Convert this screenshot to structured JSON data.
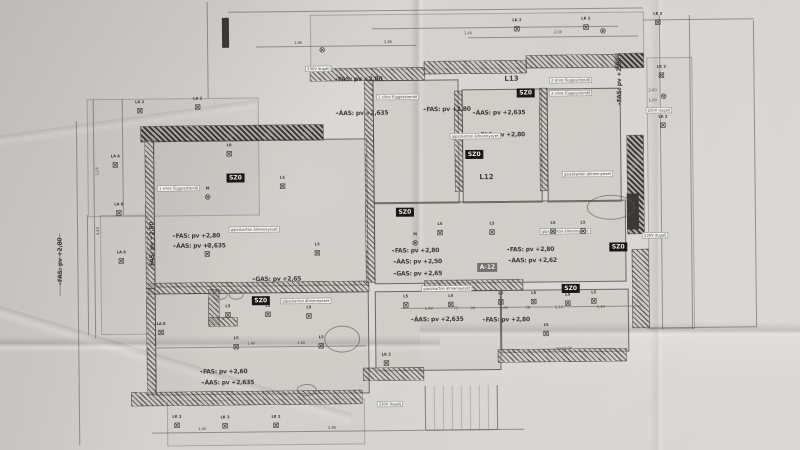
{
  "photo": {
    "colors": {
      "paper": "#d5d3cf",
      "ink": "#3b3a37",
      "chip_bg": "#171715",
      "chip_gray": "#73716d",
      "note_bg": "#f2f1ee",
      "line": "#56544f"
    }
  },
  "plan": {
    "ceiling_labels": [
      [
        "FAS: pv +2,80",
        360,
        79,
        0
      ],
      [
        "ÁAS: pv +2,635",
        363,
        113,
        0
      ],
      [
        "FAS: pv +2,80",
        448,
        110,
        0
      ],
      [
        "ÁAS: pv +2,635",
        500,
        114,
        0
      ],
      [
        "FAS: pv +2,80",
        502,
        136,
        0
      ],
      [
        "FAS: pv +2,80",
        196,
        234,
        0
      ],
      [
        "ÁAS: pv +2,635",
        199,
        244,
        0
      ],
      [
        "FAS: pv +2,80",
        415,
        251,
        0
      ],
      [
        "ÁAS: pv +2,50",
        417,
        262,
        0
      ],
      [
        "GAS: pv +2,65",
        417,
        274,
        0
      ],
      [
        "GAS: pv +2,65",
        276,
        278,
        0
      ],
      [
        "FAS: pv +2,80",
        530,
        251,
        0
      ],
      [
        "ÁAS: pv +2,62",
        532,
        262,
        0
      ],
      [
        "ÁAS: pv +2,635",
        436,
        320,
        0
      ],
      [
        "FAS: pv +2,80",
        505,
        321,
        0
      ],
      [
        "FAS: pv +2,60",
        222,
        370,
        0
      ],
      [
        "ÁAS: pv +2,635",
        226,
        381,
        0
      ],
      [
        "FAS: pv +2,80",
        152,
        243,
        -90
      ],
      [
        "FAS: pv +2,80",
        621,
        84,
        -90
      ],
      [
        "FAS: pv +2,80",
        60,
        258,
        -90
      ]
    ],
    "chips": [
      [
        "SZ0",
        236,
        176,
        ""
      ],
      [
        "SZ0",
        260,
        299,
        ""
      ],
      [
        "SZ0",
        405,
        212,
        ""
      ],
      [
        "SZ0",
        475,
        155,
        ""
      ],
      [
        "SZ0",
        527,
        94,
        ""
      ],
      [
        "SZ0",
        570,
        290,
        ""
      ],
      [
        "SZ0",
        618,
        249,
        ""
      ],
      [
        "A-12",
        487,
        268,
        "gray"
      ]
    ],
    "notes": [
      [
        "gipszkarton álmennyezet",
        254,
        228,
        ""
      ],
      [
        "gipszkarton álmennyezet",
        446,
        289,
        ""
      ],
      [
        "gipszkarton álmennyezet",
        476,
        137,
        ""
      ],
      [
        "gipszkarton álmennyezet",
        588,
        176,
        ""
      ],
      [
        "gipszkarton álmennyezet",
        305,
        300,
        ""
      ],
      [
        "gipszkarton álmennyezet",
        565,
        233,
        ""
      ],
      [
        "2 sínre függesztendő",
        572,
        82,
        ""
      ],
      [
        "2 sínre függesztendő",
        572,
        95,
        ""
      ],
      [
        "1 sínre függesztendő",
        179,
        186,
        ""
      ],
      [
        "1 sínre függesztendő",
        399,
        97,
        ""
      ],
      [
        "230V dugalj",
        320,
        68,
        ""
      ],
      [
        "230V dugalj",
        655,
        238,
        ""
      ],
      [
        "230V dugalj",
        660,
        113,
        ""
      ],
      [
        "230V dugalj",
        388,
        404,
        ""
      ],
      [
        "pv=3,00",
        563,
        350,
        "plain"
      ]
    ],
    "lamps": [
      [
        "LA 2",
        141,
        108,
        "s"
      ],
      [
        "LA 2",
        199,
        105,
        "s"
      ],
      [
        "LA 8",
        116,
        162,
        "s"
      ],
      [
        "LA 8",
        119,
        210,
        "s"
      ],
      [
        "LA 8",
        121,
        258,
        "s"
      ],
      [
        "LA 8",
        160,
        330,
        "s"
      ],
      [
        "LK 2",
        175,
        423,
        "s"
      ],
      [
        "LK 3",
        223,
        424,
        "s"
      ],
      [
        "LK 2",
        274,
        424,
        "s"
      ],
      [
        "LK 2",
        385,
        363,
        "s"
      ],
      [
        "LK 2",
        519,
        30,
        "s"
      ],
      [
        "LK 2",
        588,
        29,
        "s"
      ],
      [
        "LK 2",
        660,
        25,
        "s"
      ],
      [
        "LK 2",
        663,
        78,
        "s"
      ],
      [
        "LK 2",
        664,
        128,
        "s"
      ],
      [
        "",
        665,
        99,
        "c"
      ],
      [
        "",
        605,
        33,
        "c"
      ],
      [
        "",
        324,
        49,
        "c"
      ],
      [
        "M",
        415,
        243,
        "c"
      ],
      [
        "M",
        208,
        195,
        "c"
      ],
      [
        "L9",
        230,
        152,
        "s"
      ],
      [
        "L5",
        283,
        185,
        "s"
      ],
      [
        "L5",
        207,
        252,
        "s"
      ],
      [
        "L3",
        317,
        252,
        "s"
      ],
      [
        "L5",
        440,
        233,
        "s"
      ],
      [
        "L5",
        492,
        233,
        "s"
      ],
      [
        "L5",
        553,
        233,
        "s"
      ],
      [
        "L5",
        583,
        233,
        "s"
      ],
      [
        "L5",
        405,
        305,
        "s"
      ],
      [
        "L5",
        450,
        305,
        "s"
      ],
      [
        "L5",
        500,
        303,
        "s"
      ],
      [
        "L5",
        533,
        303,
        "s"
      ],
      [
        "L5",
        567,
        305,
        "s"
      ],
      [
        "L5",
        593,
        303,
        "s"
      ],
      [
        "L5",
        227,
        313,
        "s"
      ],
      [
        "L5",
        267,
        313,
        "s"
      ],
      [
        "L5",
        308,
        315,
        "s"
      ],
      [
        "L5",
        235,
        345,
        "s"
      ],
      [
        "L5",
        320,
        345,
        "s"
      ],
      [
        "L5",
        545,
        335,
        "s"
      ]
    ],
    "room_codes": [
      [
        "L13",
        513,
        80
      ],
      [
        "L12",
        487,
        178
      ]
    ],
    "dims": [
      [
        "1,40",
        428,
        309,
        0
      ],
      [
        "75",
        455,
        309,
        0
      ],
      [
        "90",
        472,
        309,
        0
      ],
      [
        "1,60",
        503,
        309,
        0
      ],
      [
        "58",
        527,
        309,
        0
      ],
      [
        "1,10",
        558,
        309,
        0
      ],
      [
        "1,40",
        600,
        309,
        0
      ],
      [
        "2,00",
        654,
        93,
        0
      ],
      [
        "1,00",
        654,
        103,
        0
      ],
      [
        "1,86",
        300,
        42,
        0
      ],
      [
        "2,86",
        390,
        42,
        0
      ],
      [
        "1,40",
        470,
        34,
        0
      ],
      [
        "2,00",
        560,
        34,
        0
      ],
      [
        "4,40",
        98,
        228,
        -90
      ],
      [
        "1,05",
        98,
        168,
        -90
      ],
      [
        "1,40",
        250,
        342,
        0
      ],
      [
        "1,60",
        300,
        342,
        0
      ],
      [
        "1,40",
        200,
        427,
        0
      ],
      [
        "2,86",
        330,
        427,
        0
      ]
    ],
    "walls": [
      [
        142,
        124,
        182,
        15,
        "dark"
      ],
      [
        628,
        138,
        16,
        98,
        "dark"
      ],
      [
        617,
        56,
        28,
        14,
        "dark"
      ],
      [
        312,
        68,
        114,
        12,
        ""
      ],
      [
        426,
        62,
        102,
        12,
        ""
      ],
      [
        528,
        57,
        92,
        12,
        ""
      ],
      [
        632,
        252,
        16,
        78,
        ""
      ],
      [
        148,
        281,
        220,
        10,
        ""
      ],
      [
        424,
        281,
        98,
        10,
        ""
      ],
      [
        130,
        390,
        230,
        13,
        ""
      ],
      [
        362,
        368,
        60,
        12,
        ""
      ],
      [
        497,
        351,
        128,
        12,
        ""
      ],
      [
        146,
        138,
        8,
        148,
        ""
      ],
      [
        146,
        286,
        8,
        106,
        ""
      ],
      [
        366,
        80,
        8,
        202,
        ""
      ],
      [
        456,
        92,
        7,
        100,
        ""
      ],
      [
        541,
        90,
        7,
        102,
        ""
      ],
      [
        208,
        288,
        10,
        34,
        ""
      ],
      [
        208,
        316,
        28,
        8,
        ""
      ],
      [
        224,
        16,
        7,
        30,
        "solid"
      ],
      [
        627,
        196,
        12,
        36,
        "solid"
      ]
    ],
    "rooms": [
      [
        88,
        96,
        170,
        116,
        1
      ],
      [
        154,
        138,
        212,
        145,
        0
      ],
      [
        374,
        80,
        84,
        122,
        0
      ],
      [
        463,
        90,
        78,
        112,
        0
      ],
      [
        548,
        90,
        72,
        112,
        0
      ],
      [
        374,
        202,
        250,
        80,
        0
      ],
      [
        154,
        291,
        212,
        100,
        0
      ],
      [
        374,
        291,
        124,
        78,
        0
      ],
      [
        500,
        291,
        126,
        61,
        0
      ],
      [
        648,
        60,
        44,
        270,
        1
      ],
      [
        165,
        398,
        196,
        44,
        1
      ],
      [
        100,
        212,
        46,
        118,
        1
      ],
      [
        312,
        14,
        332,
        54,
        1
      ]
    ],
    "lines": [
      [
        230,
        10,
        645,
        10
      ],
      [
        258,
        45,
        418,
        45
      ],
      [
        470,
        38,
        640,
        38
      ],
      [
        95,
        96,
        95,
        335
      ],
      [
        78,
        118,
        78,
        442
      ],
      [
        60,
        230,
        60,
        292
      ],
      [
        662,
        18,
        662,
        332
      ],
      [
        692,
        18,
        692,
        332
      ],
      [
        756,
        24,
        756,
        330
      ],
      [
        645,
        22,
        756,
        22
      ],
      [
        644,
        330,
        756,
        330
      ],
      [
        400,
        308,
        640,
        308
      ],
      [
        150,
        430,
        522,
        430
      ],
      [
        155,
        345,
        365,
        345
      ],
      [
        210,
        0,
        210,
        96
      ],
      [
        124,
        96,
        124,
        212
      ],
      [
        374,
        28,
        620,
        28
      ],
      [
        88,
        212,
        88,
        332
      ],
      [
        424,
        386,
        424,
        430
      ],
      [
        496,
        386,
        496,
        430
      ],
      [
        424,
        430,
        496,
        430
      ]
    ],
    "ovals": [
      [
        587,
        197,
        46,
        23
      ],
      [
        323,
        325,
        34,
        25
      ],
      [
        212,
        288,
        13,
        8
      ],
      [
        228,
        288,
        13,
        8
      ],
      [
        295,
        383,
        18,
        10
      ]
    ],
    "stairs": [
      424,
      386,
      72,
      44,
      8
    ]
  }
}
